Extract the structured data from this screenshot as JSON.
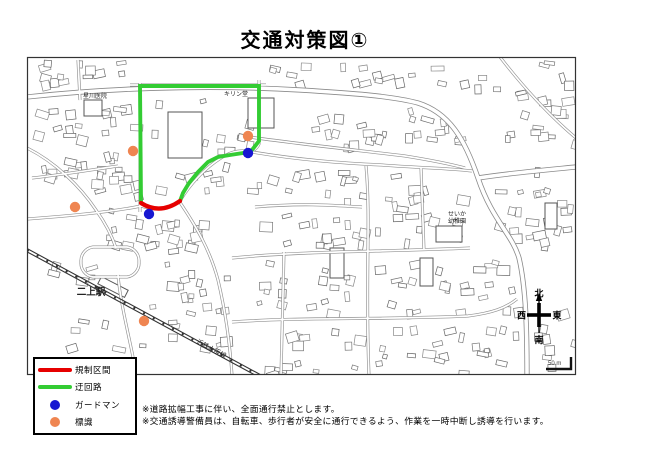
{
  "title": "交通対策図①",
  "legend": {
    "items": [
      {
        "label": "規制区間",
        "type": "line",
        "color": "#e60000"
      },
      {
        "label": "迂回路",
        "type": "line",
        "color": "#33cc33"
      },
      {
        "label": "ガードマン",
        "type": "dot",
        "color": "#1717d1"
      },
      {
        "label": "標識",
        "type": "dot",
        "color": "#ef8551"
      }
    ]
  },
  "notes": [
    "※道路拡幅工事に伴い、全面通行禁止とします。",
    "※交通誘導警備員は、自転車、歩行者が安全に通行できるよう、作業を一時中断し誘導を行います。"
  ],
  "map": {
    "place_labels": [
      {
        "text": "星川医院",
        "x": 95,
        "y": 98,
        "size": 6,
        "anchor": "middle"
      },
      {
        "text": "キリン堂",
        "x": 236,
        "y": 96,
        "size": 6,
        "anchor": "middle"
      },
      {
        "text": "せいか",
        "x": 448,
        "y": 216,
        "size": 6,
        "anchor": "start"
      },
      {
        "text": "幼稚園",
        "x": 448,
        "y": 223,
        "size": 6,
        "anchor": "start"
      },
      {
        "text": "二上駅",
        "x": 91,
        "y": 295,
        "size": 9.5,
        "anchor": "middle",
        "bold": true
      },
      {
        "text": "近鉄大阪線",
        "x": 196,
        "y": 343,
        "size": 6.5,
        "anchor": "start",
        "rot": 28
      }
    ],
    "compass": {
      "north": "北",
      "south": "南",
      "east": "東",
      "west": "西"
    },
    "scale_label": "50 m",
    "routes": {
      "restricted": {
        "name": "規制区間",
        "color": "#e60000",
        "points": [
          [
            141,
            203
          ],
          [
            160,
            215
          ],
          [
            180,
            201
          ]
        ]
      },
      "detour": {
        "name": "迂回路",
        "color": "#33cc33",
        "points": [
          [
            141,
            203
          ],
          [
            140,
            86
          ],
          [
            259,
            86
          ],
          [
            259,
            141
          ],
          [
            252,
            150
          ],
          [
            243,
            153
          ],
          [
            230,
            155
          ],
          [
            218,
            157
          ],
          [
            208,
            162
          ],
          [
            198,
            172
          ],
          [
            189,
            183
          ],
          [
            183,
            193
          ],
          [
            180,
            201
          ]
        ]
      }
    },
    "markers": {
      "guards": {
        "name": "ガードマン",
        "color": "#1717d1",
        "points": [
          [
            149,
            214
          ],
          [
            248,
            153
          ]
        ]
      },
      "signs": {
        "name": "標識",
        "color": "#ef8551",
        "points": [
          [
            133,
            151
          ],
          [
            75,
            207
          ],
          [
            144,
            321
          ],
          [
            248,
            136
          ]
        ]
      }
    }
  }
}
